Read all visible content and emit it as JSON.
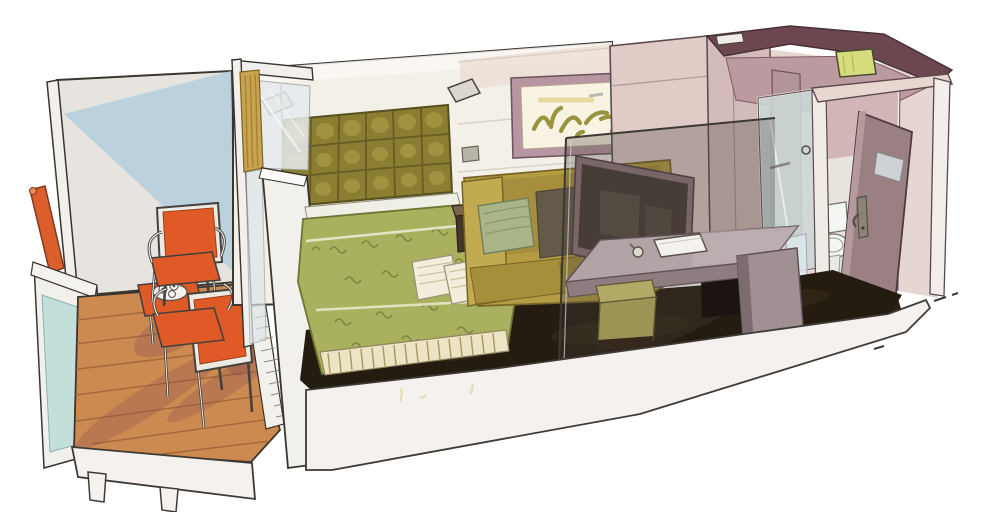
{
  "scene": {
    "kind": "hand-drawn cutaway illustration",
    "subject": "balcony stateroom (cabin) with bedroom, sitting area, bathroom and entry",
    "areas": [
      "balcony",
      "bedroom",
      "sitting-area",
      "desk-area",
      "bathroom",
      "entry-corridor"
    ],
    "objects": [
      "handrail",
      "balustrade-glass",
      "deck-chairs",
      "coffee-table",
      "curtain",
      "tufted-headboard",
      "reading-sconces",
      "double-bed",
      "decorative-pillows",
      "bedside-table",
      "sofa",
      "wall-artwork",
      "smoked-glass-screen",
      "mirror",
      "desk",
      "stool",
      "wardrobe",
      "shower-glass-door",
      "toilet",
      "entry-door",
      "ceiling-light"
    ]
  },
  "palette": {
    "paper": "#ffffff",
    "ink": "#3a352e",
    "balcony_wall": "#e7e4df",
    "balcony_wall_blue": "#b7cede",
    "hull_cut": "#f2f0ec",
    "handrail_orange": "#dd5e2d",
    "balustrade_glass": "#c2dfda",
    "deck_wood": "#cd8a50",
    "deck_plank_line": "#a2673a",
    "deck_shadow": "#8a4d52",
    "chair_orange": "#e05a28",
    "chair_frame_light": "#eceae3",
    "tray_white": "#f5f3ef",
    "threshold": "#f3f1ec",
    "curtain_gold": "#c9a44e",
    "window_glass": "#e7ebee",
    "pier_white": "#f2f0ec",
    "wall_cream": "#f3f0e8",
    "wall_seam": "#d5cfc0",
    "wall_pink": "#ead9d0",
    "art_frame": "#b795a1",
    "art_mat": "#f8f3e3",
    "art_stroke": "#99933e",
    "headboard_olive": "#8b7d31",
    "headboard_shadow": "#5f5520",
    "headboard_light": "#b5a852",
    "sconce": "#dcd8d0",
    "bed_sheet": "#f0efe5",
    "bed_green": "#a9b15f",
    "bed_pattern": "#76823a",
    "fringe": "#ece4c4",
    "pillow_cream": "#f3eedb",
    "side_table_dark": "#46362a",
    "side_table_top": "#7a6450",
    "sofa_mustard": "#b59c42",
    "sofa_arm": "#c2aa50",
    "sofa_seat": "#a58f3a",
    "sofa_pillow_sage": "#a9b488",
    "sofa_pillow_dark": "#5e564c",
    "mirror_frame": "#8e767c",
    "mirror_glass": "#453c35",
    "carpet": "#241b11",
    "glass_smoke": "#4a423c",
    "desk_top": "#b2a3a6",
    "desk_apron": "#8d7d81",
    "desk_support": "#a08f93",
    "stool_front": "#9d9355",
    "stool_top": "#b3a967",
    "tablet_white": "#f4f2ec",
    "bath_face_light": "#e0cbc6",
    "bath_face_mid": "#d2bbb8",
    "bath_backdrop": "#e6d6d2",
    "rim_maroon": "#6d4750",
    "ceiling_light": "#d6dc7d",
    "bath_inner": "#bb9aa0",
    "bath_inner_wall": "#b2959a",
    "shower_glass": "#ccd9d8",
    "jamb_white": "#f1ebe6",
    "door_mauve": "#9a7f83",
    "door_plaque": "#cdd2d6",
    "toilet_white": "#f4f6f4",
    "corridor_floor": "#2a1f15",
    "slab_white": "#f4f1ee",
    "closet_dark": "#1c1410",
    "closet_mirror": "#dde6e8",
    "header_pink": "#e8d7d0",
    "corridor_band": "#f3eeea"
  }
}
